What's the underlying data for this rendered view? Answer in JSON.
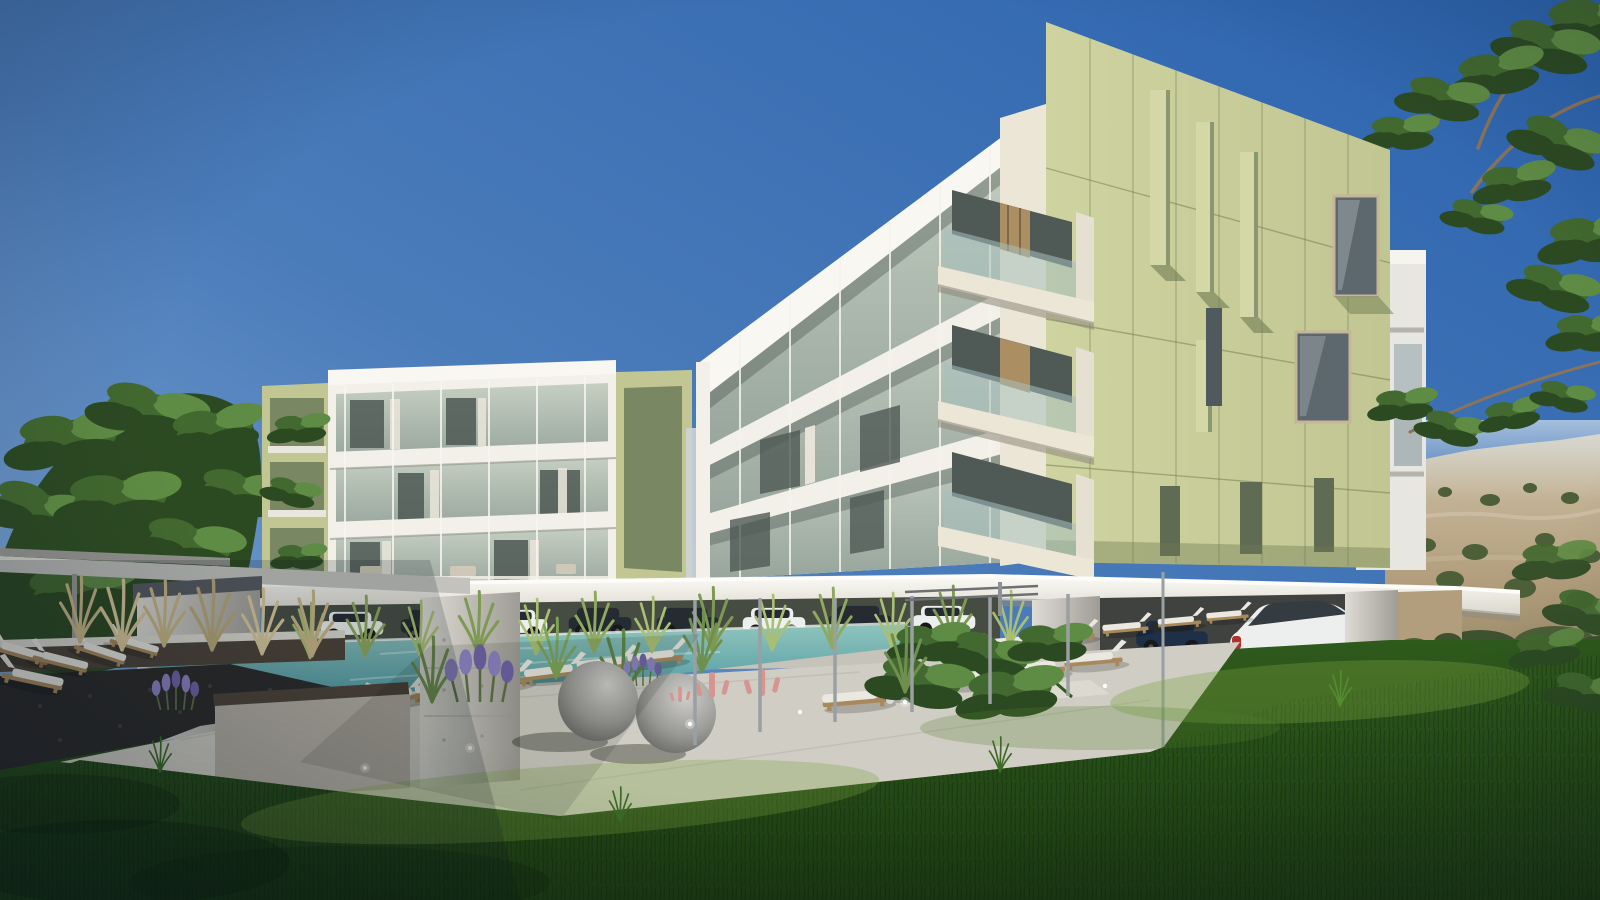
{
  "meta": {
    "type": "architectural-render",
    "description": "Photorealistic render of a modern low-rise apartment complex: two olive-green and white buildings with glass balconies, a turquoise pool lined with white sun loungers, a concrete courtyard with decorative grey spheres, pink cactus sculptures and lavender, covered parking with a white SUV and dark cars, green lawn in the foreground, trees framing the scene and a hazy rocky hillside to the right under a clear blue sky."
  },
  "scene": {
    "objects": [
      "left-apartment-building",
      "right-apartment-building",
      "background-building",
      "swimming-pool",
      "infinity-edge-stone-wall",
      "sun-loungers",
      "pergola-posts",
      "canopy-slab",
      "covered-parking",
      "white-suv",
      "dark-cars",
      "concrete-pillar",
      "planter-box",
      "decorative-spheres",
      "pink-cactus-sculptures",
      "lavender",
      "ornamental-grasses",
      "lawn",
      "left-tree",
      "overhanging-branches",
      "distant-hillside"
    ]
  },
  "palette": {
    "skyTop": "#2b63ae",
    "skyMid": "#4b7cba",
    "skyLow": "#86acd6",
    "hillHaze": "#cfc2a8",
    "hillTan": "#b29e7c",
    "hillDark": "#8f815f",
    "shrub": "#4c5f38",
    "treeDark": "#2c4a22",
    "treeMid": "#42692f",
    "treeLight": "#5f8c44",
    "branch": "#8a7458",
    "olive": "#c1c692",
    "oliveLight": "#ced3a0",
    "oliveShadow": "#9aa87c",
    "olivePanel": "#7a8763",
    "oliveFin": "#d4d8a6",
    "white": "#f2f0e8",
    "cream": "#ece6d6",
    "concrete": "#c7c4bc",
    "concreteDark": "#9d9a92",
    "slabDark": "#565a60",
    "glass": "#c6cfc2",
    "glassDark": "#97a59c",
    "curtain": "#e8e3d9",
    "interiorDark": "#4f5955",
    "wood": "#ac8e63",
    "poolLight": "#8fc4bd",
    "poolDeep": "#4f98a0",
    "stoneDark": "#2b2a29",
    "stoneCap": "#4c4238",
    "deck": "#d0cdc4",
    "deckLight": "#dcd9d0",
    "grassDark": "#1b3a11",
    "grassMid": "#2f5a1c",
    "grassLight": "#4e7f2b",
    "grassSun": "#7aa340",
    "carWhite": "#edefee",
    "carDark": "#242b33",
    "carBlue": "#1d3048",
    "lounger": "#eae8e0",
    "loungerWood": "#a8895c",
    "lavender": "#8d82c4",
    "pink": "#d6958f",
    "sphere": "#9a9a97",
    "sphereLight": "#cfcecb",
    "metal": "#9aa0a2"
  }
}
